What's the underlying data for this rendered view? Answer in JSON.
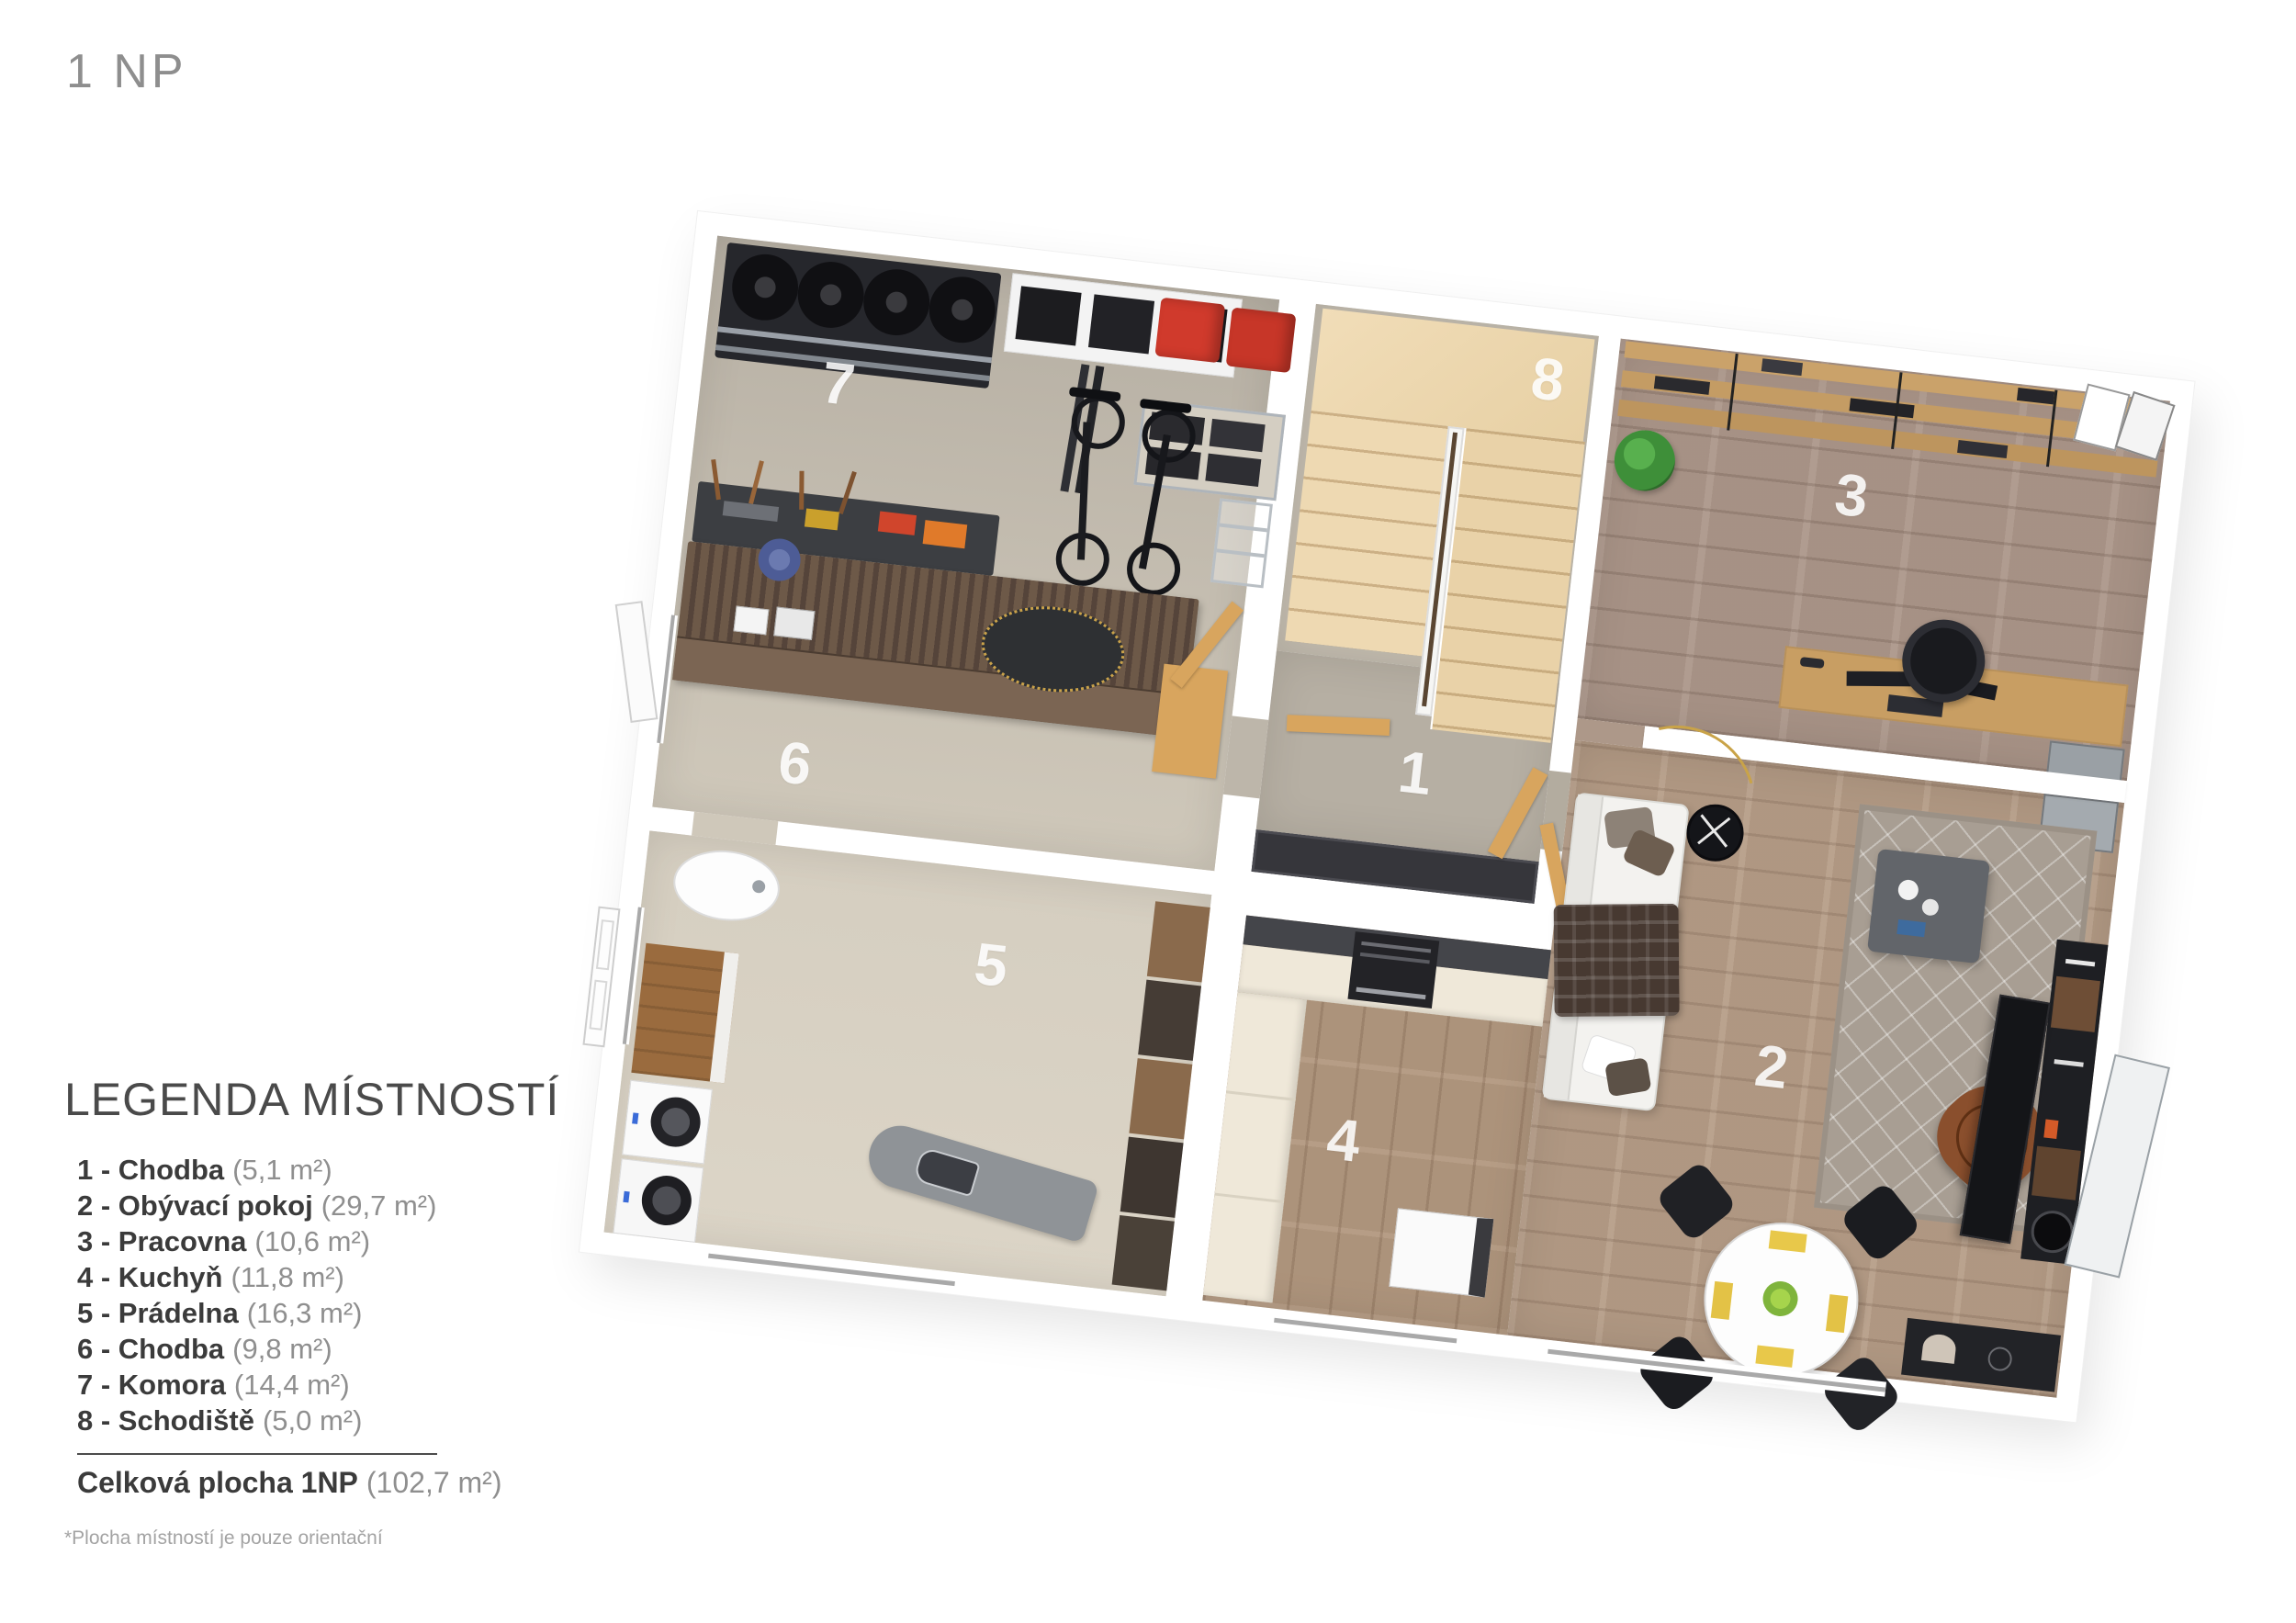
{
  "page": {
    "title": "1 NP"
  },
  "legend": {
    "title": "LEGENDA MÍSTNOSTÍ",
    "items": [
      {
        "label": "1 - Chodba",
        "area": "(5,1 m²)"
      },
      {
        "label": "2 - Obývací pokoj",
        "area": "(29,7 m²)"
      },
      {
        "label": "3 - Pracovna",
        "area": "(10,6 m²)"
      },
      {
        "label": "4 - Kuchyň",
        "area": "(11,8 m²)"
      },
      {
        "label": "5 - Prádelna",
        "area": "(16,3 m²)"
      },
      {
        "label": "6 - Chodba",
        "area": "(9,8 m²)"
      },
      {
        "label": "7 - Komora",
        "area": "(14,4 m²)"
      },
      {
        "label": "8 - Schodiště",
        "area": "(5,0 m²)"
      }
    ],
    "total_label": "Celková plocha 1NP",
    "total_area": "(102,7 m²)",
    "footnote": "*Plocha místností je pouze orientační"
  },
  "floorplan": {
    "room_labels": {
      "r1": "1",
      "r2": "2",
      "r3": "3",
      "r4": "4",
      "r5": "5",
      "r6": "6",
      "r7": "7",
      "r8": "8"
    },
    "colors": {
      "floor_concrete": "#c0b9ac",
      "floor_laundry": "#d9d2c4",
      "floor_wood_kitchen": "#b2987f",
      "floor_wood_office": "#ab9689",
      "floor_wood_living": "#b59c86",
      "stair_wood": "#eed9b2",
      "door_wood": "#d8a55e",
      "red_bins": "#d03a2c"
    }
  }
}
